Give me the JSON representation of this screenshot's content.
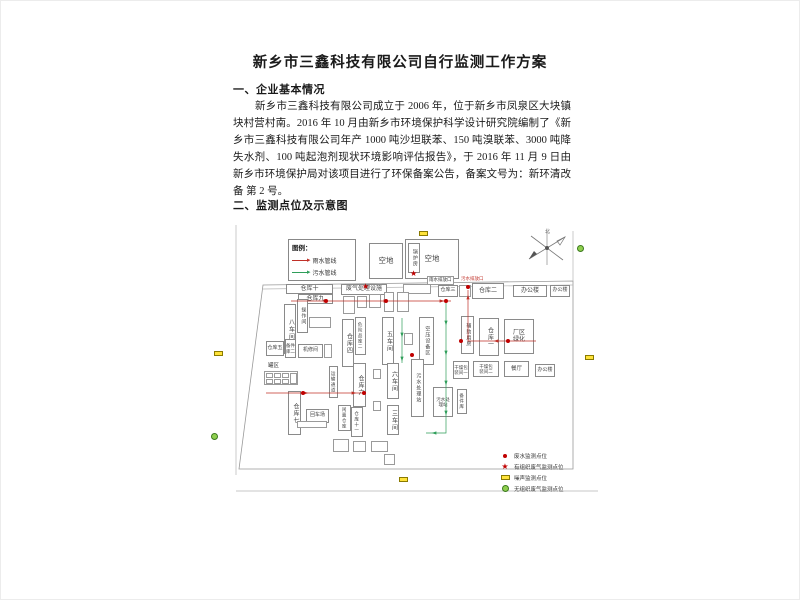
{
  "doc": {
    "title": "新乡市三鑫科技有限公司自行监测工作方案",
    "section1_heading": "一、企业基本情况",
    "section1_paragraph": "新乡市三鑫科技有限公司成立于 2006 年，位于新乡市凤泉区大块镇块村营村南。2016 年 10 月由新乡市环境保护科学设计研究院编制了《新乡市三鑫科技有限公司年产 1000 吨沙坦联苯、150 吨溴联苯、3000 吨降失水剂、100 吨起泡剂现状环境影响评估报告》，于 2016 年 11 月 9 日由新乡市环境保护局对该项目进行了环保备案公告，备案文号为：新环清改备 第 2 号。",
    "section2_heading": "二、监测点位及示意图"
  },
  "diagram": {
    "compass_label": "北",
    "pipe_legend": {
      "title": "图例：",
      "items": [
        {
          "label": "雨水管线",
          "color": "#c03028"
        },
        {
          "label": "污水管线",
          "color": "#2f9e5a"
        }
      ]
    },
    "point_legend": [
      {
        "type": "dot",
        "color": "#c00000",
        "label": "废水监测点位"
      },
      {
        "type": "star",
        "color": "#c00000",
        "label": "有组织废气监测点位"
      },
      {
        "type": "rect",
        "color": "#ffe33a",
        "label": "噪声监测点位"
      },
      {
        "type": "circle",
        "color": "#8fcf4f",
        "label": "无组织废气监测点位"
      }
    ],
    "buildings": [
      {
        "label": "空地",
        "x": 163,
        "y": 20,
        "w": 34,
        "h": 36,
        "fs": 7.5
      },
      {
        "label": "空地",
        "x": 199,
        "y": 16,
        "w": 54,
        "h": 40,
        "fs": 7.5
      },
      {
        "label": "锅炉房",
        "x": 202,
        "y": 20,
        "w": 12,
        "h": 30,
        "v": 1,
        "fs": 5
      },
      {
        "label": "仓库十",
        "x": 80,
        "y": 61,
        "w": 47,
        "h": 10
      },
      {
        "label": "仓库九",
        "x": 92,
        "y": 71,
        "w": 35,
        "h": 10
      },
      {
        "label": "八车间",
        "x": 78,
        "y": 81,
        "w": 12,
        "h": 50,
        "v": 1
      },
      {
        "label": "操作间",
        "x": 91,
        "y": 76,
        "w": 11,
        "h": 34,
        "v": 1,
        "fs": 5
      },
      {
        "label": "仓库五",
        "x": 60,
        "y": 118,
        "w": 18,
        "h": 15,
        "fs": 5
      },
      {
        "label": "备件\n库二",
        "x": 79,
        "y": 116,
        "w": 11,
        "h": 19,
        "fs": 4.5
      },
      {
        "label": "机修间",
        "x": 92,
        "y": 121,
        "w": 25,
        "h": 14,
        "fs": 5
      },
      {
        "label": "废气处理设施",
        "x": 135,
        "y": 61,
        "w": 46,
        "h": 11,
        "fs": 6
      },
      {
        "label": "仓库四",
        "x": 136,
        "y": 96,
        "w": 12,
        "h": 48,
        "v": 1
      },
      {
        "label": "危险品库二",
        "x": 149,
        "y": 94,
        "w": 11,
        "h": 38,
        "v": 1,
        "fs": 4.5
      },
      {
        "label": "五车间",
        "x": 176,
        "y": 94,
        "w": 12,
        "h": 48,
        "v": 1
      },
      {
        "label": "空压设备区",
        "x": 213,
        "y": 94,
        "w": 15,
        "h": 48,
        "v": 1,
        "fs": 5
      },
      {
        "label": "仓库三",
        "x": 232,
        "y": 62,
        "w": 20,
        "h": 12,
        "fs": 5
      },
      {
        "label": "仓库二",
        "x": 266,
        "y": 60,
        "w": 32,
        "h": 16
      },
      {
        "label": "办公楼",
        "x": 307,
        "y": 62,
        "w": 34,
        "h": 12
      },
      {
        "label": "办公楼",
        "x": 344,
        "y": 62,
        "w": 20,
        "h": 12,
        "fs": 5
      },
      {
        "label": "辅助用房",
        "x": 255,
        "y": 93,
        "w": 13,
        "h": 38,
        "v": 1,
        "fs": 5
      },
      {
        "label": "仓库一",
        "x": 273,
        "y": 95,
        "w": 20,
        "h": 38,
        "v": 1
      },
      {
        "label": "厂区\n绿化",
        "x": 298,
        "y": 96,
        "w": 30,
        "h": 35,
        "fs": 6
      },
      {
        "label": "干燥包\n装间一",
        "x": 247,
        "y": 138,
        "w": 16,
        "h": 18,
        "fs": 4.5
      },
      {
        "label": "干燥包\n装间二",
        "x": 267,
        "y": 138,
        "w": 26,
        "h": 16,
        "fs": 4.5
      },
      {
        "label": "餐厅",
        "x": 298,
        "y": 138,
        "w": 25,
        "h": 16,
        "fs": 5.5
      },
      {
        "label": "办公楼",
        "x": 329,
        "y": 141,
        "w": 20,
        "h": 13,
        "fs": 5
      },
      {
        "label": "污水处理站",
        "x": 205,
        "y": 136,
        "w": 13,
        "h": 58,
        "v": 1,
        "fs": 5
      },
      {
        "label": "污水处\n理站",
        "x": 227,
        "y": 164,
        "w": 20,
        "h": 30,
        "fs": 4.5
      },
      {
        "label": "备件库",
        "x": 251,
        "y": 166,
        "w": 10,
        "h": 25,
        "v": 1,
        "fs": 4.5
      },
      {
        "label": "仓库六",
        "x": 147,
        "y": 140,
        "w": 13,
        "h": 44,
        "v": 1
      },
      {
        "label": "仓库七",
        "x": 82,
        "y": 168,
        "w": 13,
        "h": 44,
        "v": 1
      },
      {
        "label": "回车场",
        "x": 100,
        "y": 186,
        "w": 23,
        "h": 14,
        "fs": 5
      },
      {
        "label": "闲置仓库",
        "x": 132,
        "y": 182,
        "w": 13,
        "h": 26,
        "v": 1,
        "fs": 4.5
      },
      {
        "label": "仓库十一",
        "x": 145,
        "y": 184,
        "w": 12,
        "h": 30,
        "v": 1,
        "fs": 4.5
      },
      {
        "label": "六车间",
        "x": 181,
        "y": 140,
        "w": 12,
        "h": 36,
        "v": 1
      },
      {
        "label": "三车间",
        "x": 181,
        "y": 182,
        "w": 12,
        "h": 30,
        "v": 1
      },
      {
        "label": "运输通道",
        "x": 123,
        "y": 143,
        "w": 9,
        "h": 32,
        "v": 1,
        "fs": 4.5
      }
    ],
    "micro_boxes": [
      [
        103,
        94,
        22,
        11
      ],
      [
        118,
        121,
        8,
        14
      ],
      [
        197,
        61,
        28,
        10
      ],
      [
        137,
        73,
        12,
        18
      ],
      [
        151,
        73,
        10,
        12
      ],
      [
        163,
        71,
        12,
        14
      ],
      [
        178,
        69,
        10,
        20
      ],
      [
        191,
        69,
        12,
        20
      ],
      [
        253,
        62,
        12,
        12
      ],
      [
        198,
        110,
        9,
        12
      ],
      [
        58,
        148,
        34,
        14
      ],
      [
        60,
        150,
        7,
        5
      ],
      [
        68,
        150,
        7,
        5
      ],
      [
        76,
        150,
        7,
        5
      ],
      [
        60,
        156,
        7,
        5
      ],
      [
        68,
        156,
        7,
        5
      ],
      [
        76,
        156,
        7,
        5
      ],
      [
        84,
        150,
        7,
        11
      ],
      [
        167,
        146,
        8,
        10
      ],
      [
        167,
        178,
        8,
        10
      ],
      [
        91,
        198,
        30,
        7
      ],
      [
        127,
        216,
        16,
        13
      ],
      [
        147,
        218,
        13,
        11
      ],
      [
        165,
        218,
        17,
        11
      ],
      [
        178,
        231,
        11,
        11
      ]
    ],
    "free_labels": [
      {
        "text": "罐区",
        "x": 62,
        "y": 141,
        "fs": 5.5
      },
      {
        "text": "雨水排放口",
        "x": 221,
        "y": 53,
        "fs": 4.5,
        "boxed": 1
      },
      {
        "text": "污水排放口",
        "x": 255,
        "y": 54,
        "fs": 4.5,
        "color": "#c03028"
      }
    ],
    "markers": [
      {
        "type": "rect",
        "x": 213,
        "y": 8
      },
      {
        "type": "rect",
        "x": 8,
        "y": 128
      },
      {
        "type": "rect",
        "x": 379,
        "y": 132
      },
      {
        "type": "rect",
        "x": 193,
        "y": 254
      },
      {
        "type": "circle",
        "x": 371,
        "y": 22
      },
      {
        "type": "circle",
        "x": 5,
        "y": 210
      },
      {
        "type": "star",
        "x": 204,
        "y": 47
      },
      {
        "type": "star",
        "x": 156,
        "y": 60
      },
      {
        "type": "dot",
        "x": 260,
        "y": 62
      },
      {
        "type": "dot",
        "x": 118,
        "y": 76
      },
      {
        "type": "dot",
        "x": 178,
        "y": 76
      },
      {
        "type": "dot",
        "x": 238,
        "y": 76
      },
      {
        "type": "dot",
        "x": 253,
        "y": 116
      },
      {
        "type": "dot",
        "x": 300,
        "y": 116
      },
      {
        "type": "dot",
        "x": 95,
        "y": 168
      },
      {
        "type": "dot",
        "x": 156,
        "y": 168
      },
      {
        "type": "dot",
        "x": 204,
        "y": 130
      }
    ],
    "pipes": [
      {
        "color": "#c03028",
        "pts": [
          [
            85,
            78
          ],
          [
            245,
            78
          ]
        ],
        "arrows": [
          [
            120,
            78,
            "r"
          ],
          [
            180,
            78,
            "r"
          ],
          [
            236,
            78,
            "r"
          ]
        ]
      },
      {
        "color": "#c03028",
        "pts": [
          [
            262,
            67
          ],
          [
            262,
            118
          ],
          [
            330,
            118
          ]
        ],
        "arrows": [
          [
            262,
            74,
            "u"
          ],
          [
            290,
            118,
            "l"
          ]
        ]
      },
      {
        "color": "#c03028",
        "pts": [
          [
            60,
            170
          ],
          [
            160,
            170
          ]
        ],
        "arrows": [
          [
            100,
            170,
            "r"
          ],
          [
            148,
            170,
            "r"
          ]
        ]
      },
      {
        "color": "#2f9e5a",
        "pts": [
          [
            240,
            80
          ],
          [
            240,
            210
          ],
          [
            220,
            210
          ]
        ],
        "arrows": [
          [
            240,
            100,
            "d"
          ],
          [
            240,
            130,
            "d"
          ],
          [
            240,
            160,
            "d"
          ],
          [
            240,
            190,
            "d"
          ],
          [
            228,
            210,
            "l"
          ]
        ]
      },
      {
        "color": "#2f9e5a",
        "pts": [
          [
            196,
            95
          ],
          [
            196,
            140
          ]
        ],
        "arrows": [
          [
            196,
            112,
            "d"
          ],
          [
            196,
            136,
            "d"
          ]
        ]
      }
    ],
    "boundary": {
      "polygon": [
        [
          57,
          62
        ],
        [
          367,
          58
        ],
        [
          367,
          246
        ],
        [
          33,
          246
        ]
      ],
      "lines": [
        [
          [
            30,
            2
          ],
          [
            30,
            252
          ]
        ],
        [
          [
            367,
            8
          ],
          [
            367,
            58
          ]
        ],
        [
          [
            57,
            66
          ],
          [
            367,
            62
          ]
        ],
        [
          [
            30,
            268
          ],
          [
            392,
            268
          ]
        ]
      ]
    }
  }
}
